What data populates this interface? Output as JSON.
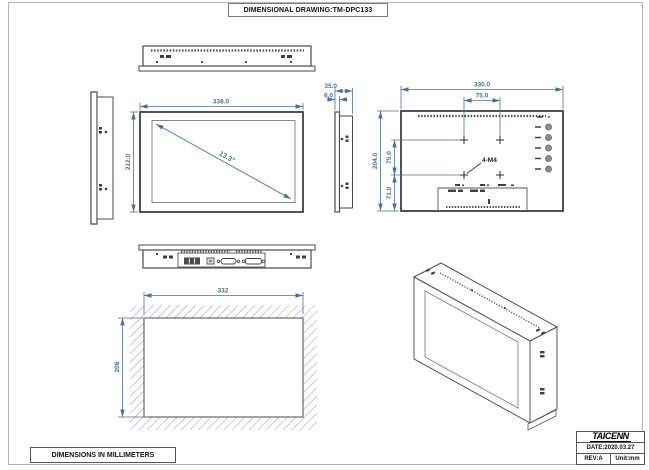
{
  "page": {
    "title": "DIMENSIONAL DRAWING:TM-DPC133",
    "footer_note": "DIMENSIONS IN MILLIMETERS"
  },
  "title_block": {
    "brand": "TAICENN",
    "date": "DATE:2020.03.27",
    "revision": "REV:A",
    "unit": "Unit:mm"
  },
  "views": {
    "front": {
      "width": "338.0",
      "height": "212.0",
      "diagonal": "13.3\""
    },
    "side": {
      "depth": "35.0",
      "bezel": "6.0"
    },
    "rear": {
      "width": "330.0",
      "height": "204.0",
      "vesa_horizontal": "75.0",
      "vesa_vertical": "75.0",
      "bottom_offset": "71.0",
      "mounting_holes": "4-M4"
    },
    "cutout": {
      "width": "332",
      "height": "206"
    }
  },
  "colors": {
    "dimension_blue": "#4a6f9f",
    "outline": "#3f3f3f",
    "hatch": "#9a9a9a"
  }
}
